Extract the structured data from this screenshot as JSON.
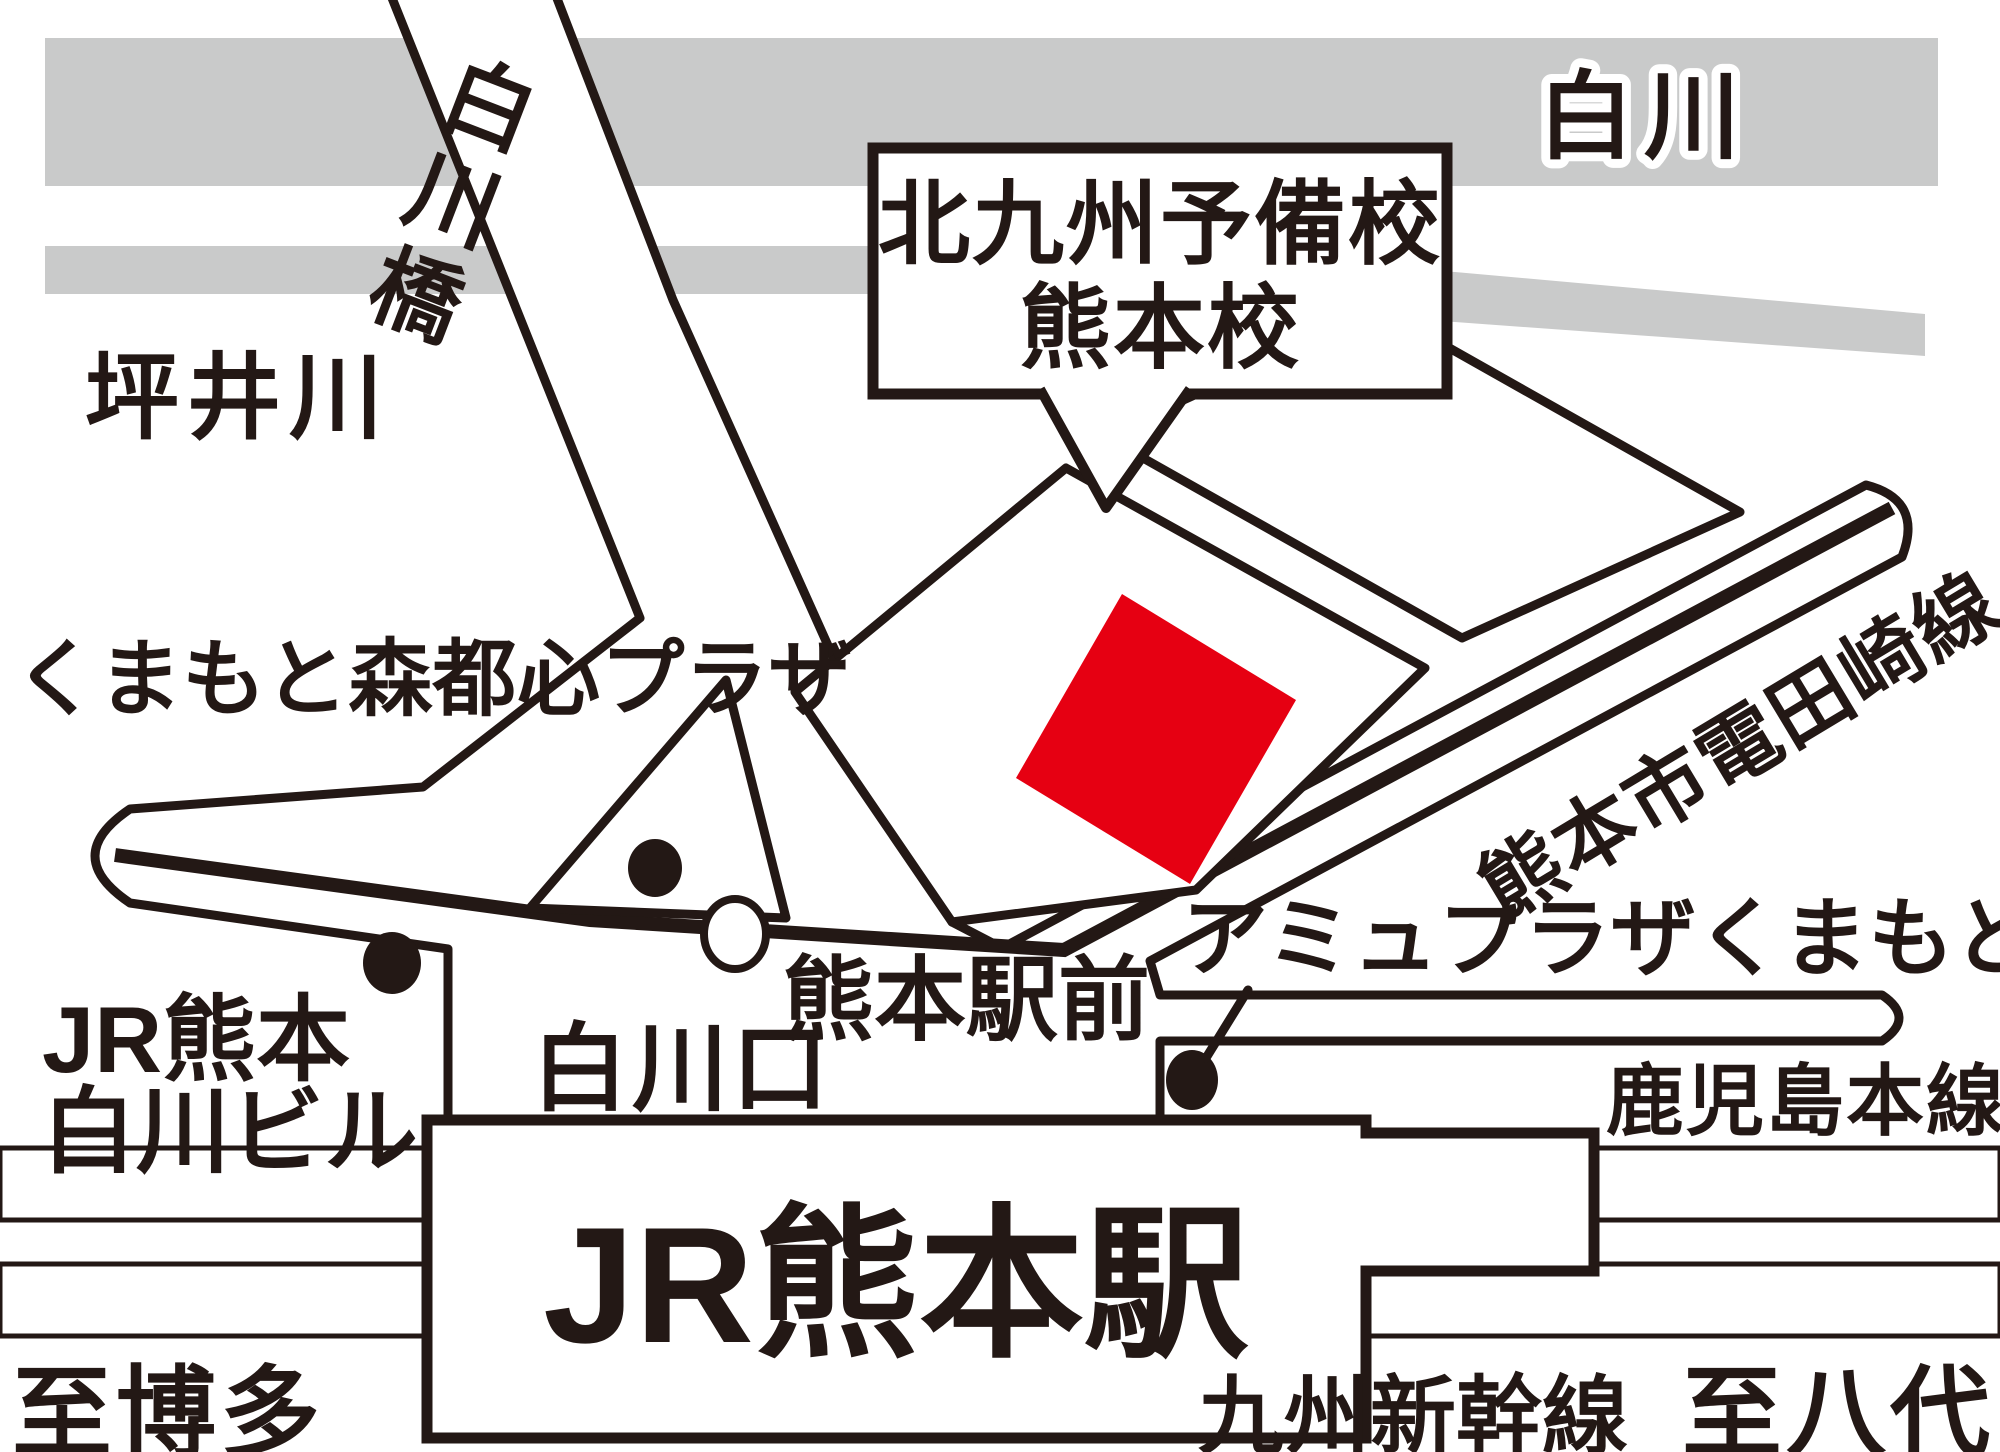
{
  "map_title": "北九州予備校 熊本校 案内図",
  "colors": {
    "ink": "#231815",
    "gray": "#c9caca",
    "red": "#e60012",
    "white": "#ffffff"
  },
  "labels": {
    "river_top": "白川",
    "river_left": "坪井川",
    "bridge": "白川橋",
    "callout_line1": "北九州予備校",
    "callout_line2": "熊本校",
    "plaza": "くまもと森都心プラザ",
    "tram_route": "熊本市電田崎線",
    "tram_stop": "熊本駅前",
    "jr_building_line1": "JR熊本",
    "jr_building_line2": "白川ビル",
    "station_exit": "白川口",
    "amu_plaza": "アミュプラザくまもと",
    "kagoshima_line": "鹿児島本線",
    "station": "JR熊本駅",
    "shinkansen": "九州新幹線",
    "to_hakata": "至博多",
    "to_yatsushiro": "至八代"
  },
  "markers": {
    "plaza_dot": "building-marker",
    "jr_building_dot": "building-marker",
    "amu_dot": "building-marker",
    "tram_stop_circle": "tram-stop-marker",
    "school_building": "highlighted-building"
  }
}
